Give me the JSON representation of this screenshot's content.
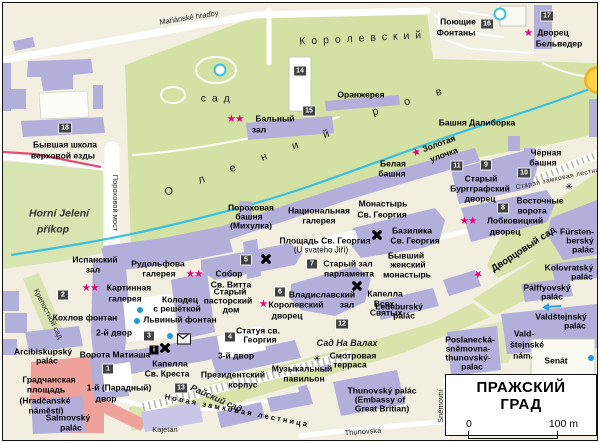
{
  "map": {
    "title": "ПРАЖСКИЙ ГРАД",
    "scale": {
      "start": "0",
      "end": "100 m"
    },
    "colors": {
      "accent_star": "#e6007e",
      "building": "#b3afdb",
      "garden": "#d3e1a5",
      "stream": "#3cc0e0",
      "square_red": "#efa29c",
      "badge": "#414141"
    },
    "labels": [
      {
        "t": "Mariánské hradby",
        "x": 186,
        "y": 15,
        "c": "street",
        "r": -9
      },
      {
        "t": "К о р о л е в с к и й",
        "x": 358,
        "y": 36,
        "c": "topo",
        "r": -3
      },
      {
        "t": "с а д",
        "x": 213,
        "y": 96,
        "c": "topo"
      },
      {
        "t": "О л е н и й",
        "x": 250,
        "y": 159,
        "c": "topo-wide",
        "r": -20
      },
      {
        "t": "р о в",
        "x": 410,
        "y": 98,
        "c": "topo-wide",
        "r": -17
      },
      {
        "t": "Horní Jelení",
        "x": 56,
        "y": 211,
        "c": "nat"
      },
      {
        "t": "příkop",
        "x": 50,
        "y": 227,
        "c": "nat"
      },
      {
        "t": "Пороховой мост",
        "x": 112,
        "y": 200,
        "c": "street",
        "r": 90
      },
      {
        "t": "Крепостной сад",
        "x": 45,
        "y": 311,
        "c": "street",
        "r": 63
      },
      {
        "t": "Райский сад",
        "x": 213,
        "y": 396,
        "c": "nat2",
        "r": 24
      },
      {
        "t": "Новая замковая лестница",
        "x": 234,
        "y": 408,
        "c": "spread",
        "r": 11
      },
      {
        "t": "Сад На Валах",
        "x": 344,
        "y": 341,
        "c": "nat2"
      },
      {
        "t": "Дворцовый сад",
        "x": 521,
        "y": 247,
        "c": "lbl9",
        "r": -33
      },
      {
        "t": "Старая замковая лестница",
        "x": 559,
        "y": 176,
        "c": "street-sm",
        "r": -12
      },
      {
        "t": "Thunovská",
        "x": 360,
        "y": 429,
        "c": "street",
        "r": -4
      },
      {
        "t": "Sněmovní",
        "x": 438,
        "y": 403,
        "c": "street",
        "r": -90
      },
      {
        "t": "Kajetán",
        "x": 162,
        "y": 427,
        "c": "street"
      },
      {
        "t": "Поющие",
        "x": 455,
        "y": 19
      },
      {
        "t": "Фонтаны",
        "x": 453,
        "y": 30
      },
      {
        "t": "Дворец",
        "x": 550,
        "y": 30
      },
      {
        "t": "Бельведер",
        "x": 556,
        "y": 41
      },
      {
        "t": "Оранжерея",
        "x": 358,
        "y": 92
      },
      {
        "t": "Бальный",
        "x": 272,
        "y": 116
      },
      {
        "t": "зал",
        "x": 256,
        "y": 127
      },
      {
        "t": "Башня Далиборка",
        "x": 474,
        "y": 120
      },
      {
        "t": "Белая",
        "x": 390,
        "y": 161
      },
      {
        "t": "башня",
        "x": 389,
        "y": 171
      },
      {
        "t": "Золотая",
        "x": 436,
        "y": 141,
        "r": -20
      },
      {
        "t": "улочка",
        "x": 441,
        "y": 152,
        "r": -20
      },
      {
        "t": "Чёрная",
        "x": 543,
        "y": 150
      },
      {
        "t": "башня",
        "x": 540,
        "y": 160
      },
      {
        "t": "Старый",
        "x": 478,
        "y": 176
      },
      {
        "t": "Бургграфский",
        "x": 477,
        "y": 186
      },
      {
        "t": "дворец",
        "x": 477,
        "y": 196
      },
      {
        "t": "Восточные",
        "x": 537,
        "y": 198
      },
      {
        "t": "ворота",
        "x": 529,
        "y": 208
      },
      {
        "t": "Лобковицкий",
        "x": 512,
        "y": 218
      },
      {
        "t": "дворец",
        "x": 502,
        "y": 229
      },
      {
        "t": "Монастырь",
        "x": 380,
        "y": 201
      },
      {
        "t": "Св. Георгия",
        "x": 379,
        "y": 212
      },
      {
        "t": "Национальная",
        "x": 316,
        "y": 208
      },
      {
        "t": "галерея",
        "x": 316,
        "y": 218
      },
      {
        "t": "Пороховая",
        "x": 248,
        "y": 205
      },
      {
        "t": "башня",
        "x": 246,
        "y": 214
      },
      {
        "t": "(Михулка)",
        "x": 248,
        "y": 223
      },
      {
        "t": "Площадь Св. Георгия",
        "x": 322,
        "y": 238
      },
      {
        "t": "(U svatého Jiří)",
        "x": 318,
        "y": 248,
        "c": "reg"
      },
      {
        "t": "Базилика",
        "x": 409,
        "y": 228
      },
      {
        "t": "Св. Георгия",
        "x": 412,
        "y": 238
      },
      {
        "t": "Бывший",
        "x": 403,
        "y": 253
      },
      {
        "t": "женский",
        "x": 405,
        "y": 262
      },
      {
        "t": "монастырь",
        "x": 404,
        "y": 272
      },
      {
        "t": "Старый зал",
        "x": 345,
        "y": 261
      },
      {
        "t": "парламента",
        "x": 346,
        "y": 271
      },
      {
        "t": "Испанский",
        "x": 92,
        "y": 257
      },
      {
        "t": "зал",
        "x": 90,
        "y": 267
      },
      {
        "t": "Рудольфова",
        "x": 155,
        "y": 261
      },
      {
        "t": "галерея",
        "x": 156,
        "y": 271
      },
      {
        "t": "Собор",
        "x": 226,
        "y": 271
      },
      {
        "t": "Св. Витта",
        "x": 228,
        "y": 282
      },
      {
        "t": "Картинная",
        "x": 126,
        "y": 285
      },
      {
        "t": "галерея",
        "x": 122,
        "y": 296
      },
      {
        "t": "Кохлов фонтан",
        "x": 82,
        "y": 315
      },
      {
        "t": "Колодец",
        "x": 177,
        "y": 297
      },
      {
        "t": "с решёткой",
        "x": 174,
        "y": 306
      },
      {
        "t": "Львиный фонтан",
        "x": 177,
        "y": 317
      },
      {
        "t": "Старый",
        "x": 227,
        "y": 289
      },
      {
        "t": "пасторский",
        "x": 225,
        "y": 298
      },
      {
        "t": "дом",
        "x": 228,
        "y": 307
      },
      {
        "t": "Владиславский",
        "x": 319,
        "y": 292
      },
      {
        "t": "зал",
        "x": 344,
        "y": 302
      },
      {
        "t": "Королевский",
        "x": 293,
        "y": 302
      },
      {
        "t": "дворец",
        "x": 284,
        "y": 313
      },
      {
        "t": "Капелла",
        "x": 382,
        "y": 291
      },
      {
        "t": "Всех",
        "x": 381,
        "y": 301
      },
      {
        "t": "Святых",
        "x": 383,
        "y": 310
      },
      {
        "t": "Статуя св.",
        "x": 255,
        "y": 328
      },
      {
        "t": "Георгия",
        "x": 257,
        "y": 337
      },
      {
        "t": "2-й двор",
        "x": 111,
        "y": 330
      },
      {
        "t": "Ворота Матиаша",
        "x": 112,
        "y": 352
      },
      {
        "t": "Капелла",
        "x": 167,
        "y": 361
      },
      {
        "t": "Св. Креста",
        "x": 164,
        "y": 371
      },
      {
        "t": "1-й (Парадный)",
        "x": 116,
        "y": 385
      },
      {
        "t": "двор",
        "x": 103,
        "y": 396
      },
      {
        "t": "Градчанская",
        "x": 46,
        "y": 377
      },
      {
        "t": "площадь",
        "x": 43,
        "y": 387
      },
      {
        "t": "(Hradčanské",
        "x": 42,
        "y": 398
      },
      {
        "t": "náměstí)",
        "x": 43,
        "y": 408
      },
      {
        "t": "Arcibiskupský",
        "x": 40,
        "y": 349
      },
      {
        "t": "palác",
        "x": 44,
        "y": 358
      },
      {
        "t": "Salmovský",
        "x": 65,
        "y": 415
      },
      {
        "t": "palác",
        "x": 68,
        "y": 425
      },
      {
        "t": "Президентский",
        "x": 230,
        "y": 372
      },
      {
        "t": "корпус",
        "x": 240,
        "y": 382
      },
      {
        "t": "3-й двор",
        "x": 233,
        "y": 353
      },
      {
        "t": "Музыкальный",
        "x": 299,
        "y": 366
      },
      {
        "t": "павильон",
        "x": 301,
        "y": 376
      },
      {
        "t": "Смотровая",
        "x": 350,
        "y": 353
      },
      {
        "t": "терраса",
        "x": 347,
        "y": 362
      },
      {
        "t": "Thunovský palác",
        "x": 379,
        "y": 388
      },
      {
        "t": "(Embassy of",
        "x": 377,
        "y": 397
      },
      {
        "t": "Great Britian)",
        "x": 379,
        "y": 406
      },
      {
        "t": "Poslanecká-",
        "x": 467,
        "y": 337
      },
      {
        "t": "sněmovna-",
        "x": 465,
        "y": 346
      },
      {
        "t": "thunovský-",
        "x": 465,
        "y": 355
      },
      {
        "t": "palac",
        "x": 469,
        "y": 364
      },
      {
        "t": "Vald-",
        "x": 521,
        "y": 331
      },
      {
        "t": "štejnské",
        "x": 524,
        "y": 342
      },
      {
        "t": "nám.",
        "x": 520,
        "y": 353
      },
      {
        "t": "Senát",
        "x": 553,
        "y": 358
      },
      {
        "t": "Fürsten-",
        "x": 574,
        "y": 229
      },
      {
        "t": "berský",
        "x": 577,
        "y": 238
      },
      {
        "t": "palác",
        "x": 580,
        "y": 247
      },
      {
        "t": "Kolovratský",
        "x": 566,
        "y": 265
      },
      {
        "t": "palác",
        "x": 579,
        "y": 274
      },
      {
        "t": "Pálffyovský",
        "x": 544,
        "y": 285
      },
      {
        "t": "palác",
        "x": 549,
        "y": 294
      },
      {
        "t": "Ledeburský",
        "x": 396,
        "y": 304
      },
      {
        "t": "palác",
        "x": 401,
        "y": 313
      },
      {
        "t": "Valdštejnský",
        "x": 558,
        "y": 314
      },
      {
        "t": "palác",
        "x": 572,
        "y": 323
      },
      {
        "t": "Бывшая школа",
        "x": 62,
        "y": 142
      },
      {
        "t": "верховой езды",
        "x": 60,
        "y": 153
      }
    ],
    "badges": [
      {
        "n": "1",
        "x": 105,
        "y": 366
      },
      {
        "n": "2",
        "x": 60,
        "y": 292
      },
      {
        "n": "3",
        "x": 146,
        "y": 333
      },
      {
        "n": "4",
        "x": 227,
        "y": 334
      },
      {
        "n": "5",
        "x": 243,
        "y": 257
      },
      {
        "n": "6",
        "x": 277,
        "y": 289
      },
      {
        "n": "7",
        "x": 309,
        "y": 261
      },
      {
        "n": "8",
        "x": 500,
        "y": 205
      },
      {
        "n": "9",
        "x": 483,
        "y": 162
      },
      {
        "n": "10",
        "x": 521,
        "y": 170
      },
      {
        "n": "11",
        "x": 454,
        "y": 163
      },
      {
        "n": "12",
        "x": 339,
        "y": 321
      },
      {
        "n": "13",
        "x": 178,
        "y": 385
      },
      {
        "n": "14",
        "x": 297,
        "y": 68
      },
      {
        "n": "15",
        "x": 306,
        "y": 108
      },
      {
        "n": "16",
        "x": 484,
        "y": 21
      },
      {
        "n": "17",
        "x": 544,
        "y": 13
      },
      {
        "n": "18",
        "x": 62,
        "y": 125
      }
    ],
    "stars": [
      {
        "n": 2,
        "x": 232,
        "y": 116
      },
      {
        "n": 1,
        "x": 525,
        "y": 30
      },
      {
        "n": 1,
        "x": 413,
        "y": 150,
        "r": -20
      },
      {
        "n": 2,
        "x": 465,
        "y": 218
      },
      {
        "n": 2,
        "x": 191,
        "y": 271
      },
      {
        "n": 2,
        "x": 87,
        "y": 285
      },
      {
        "n": 1,
        "x": 260,
        "y": 301
      },
      {
        "n": 1,
        "x": 475,
        "y": 272,
        "r": -33
      }
    ],
    "icons": [
      {
        "k": "church",
        "x": 263,
        "y": 256
      },
      {
        "k": "church",
        "x": 374,
        "y": 232
      },
      {
        "k": "church",
        "x": 354,
        "y": 283
      },
      {
        "k": "church",
        "x": 162,
        "y": 345
      },
      {
        "k": "info",
        "x": 151,
        "y": 347
      },
      {
        "k": "post",
        "x": 181,
        "y": 336
      },
      {
        "k": "view",
        "x": 314,
        "y": 356
      },
      {
        "k": "view",
        "x": 566,
        "y": 184
      },
      {
        "k": "fountain",
        "x": 137,
        "y": 307
      },
      {
        "k": "fountain",
        "x": 134,
        "y": 318
      },
      {
        "k": "fountain",
        "x": 167,
        "y": 333
      },
      {
        "k": "fountain",
        "x": 588,
        "y": 355
      },
      {
        "k": "pond",
        "x": 217,
        "y": 67
      },
      {
        "k": "pond",
        "x": 497,
        "y": 11
      },
      {
        "k": "roundabout",
        "x": 595,
        "y": 77
      },
      {
        "k": "arrow",
        "x": 548,
        "y": 304
      }
    ]
  }
}
